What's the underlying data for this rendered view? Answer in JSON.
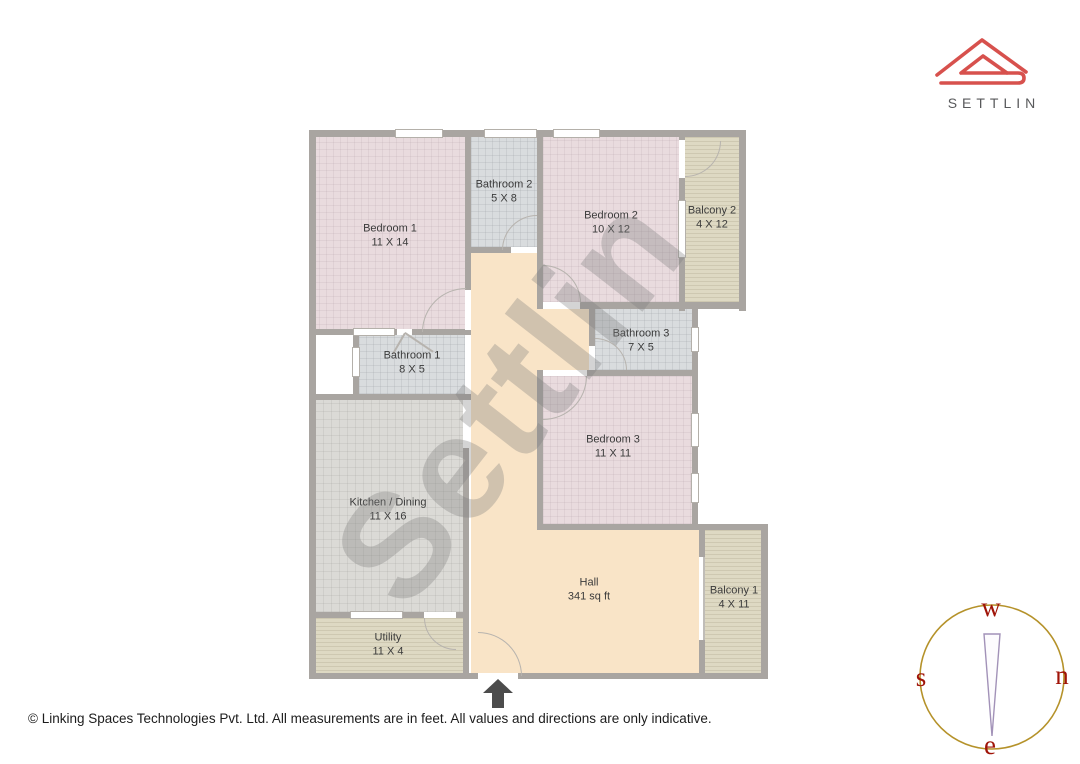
{
  "brand": {
    "name": "SETTLIN",
    "logo_icon": "settlin-house-icon",
    "logo_color": "#d7514d",
    "text_color": "#58595b"
  },
  "watermark": {
    "text": "Settlin"
  },
  "rooms": [
    {
      "name": "Bedroom 1",
      "dims": "11 X 14"
    },
    {
      "name": "Bathroom 2",
      "dims": "5 X 8"
    },
    {
      "name": "Bedroom 2",
      "dims": "10 X 12"
    },
    {
      "name": "Balcony 2",
      "dims": "4 X 12"
    },
    {
      "name": "Bathroom 3",
      "dims": "7 X 5"
    },
    {
      "name": "Bathroom 1",
      "dims": "8 X 5"
    },
    {
      "name": "Bedroom 3",
      "dims": "11 X 11"
    },
    {
      "name": "Kitchen / Dining",
      "dims": "11 X 16"
    },
    {
      "name": "Utility",
      "dims": "11 X 4"
    },
    {
      "name": "Hall",
      "dims": "341 sq ft"
    },
    {
      "name": "Balcony 1",
      "dims": "4 X 11"
    }
  ],
  "entrance": {
    "icon": "entrance-arrow-icon"
  },
  "compass": {
    "icon": "compass-rose-icon",
    "top": "w",
    "left": "s",
    "right": "n",
    "bottom": "e",
    "ring_color": "#b5922a",
    "letter_color": "#a01408",
    "needle_color": "#a292b8"
  },
  "footer": {
    "text": "© Linking Spaces Technologies Pvt. Ltd. All measurements are in feet. All values and directions are only indicative."
  },
  "palette": {
    "wall": "#a9a5a1",
    "bedroom_floor": "#e9dbde",
    "bathroom_floor": "#d9dcde",
    "kitchen_floor": "#dbdad6",
    "balcony_floor": "#ded9c3",
    "hall_floor": "#f9e4c7"
  }
}
